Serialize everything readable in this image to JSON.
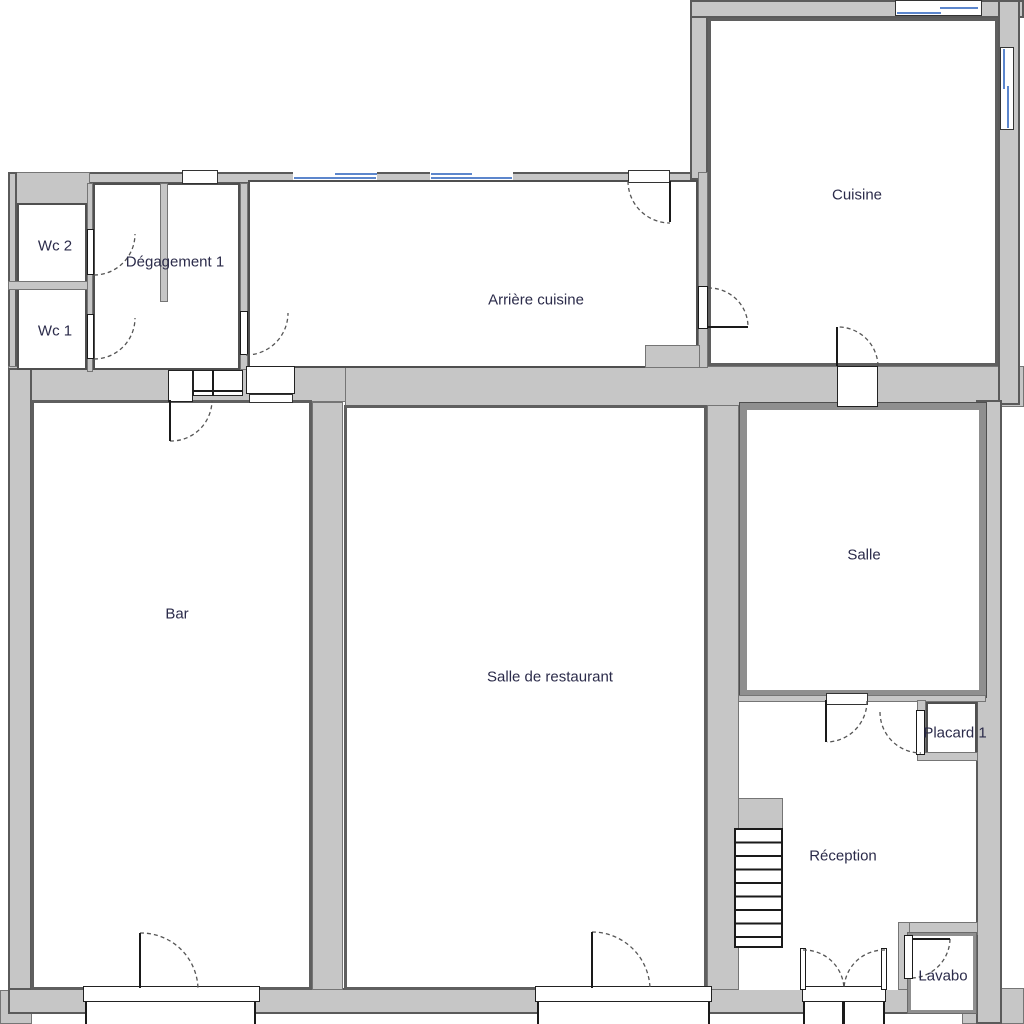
{
  "plan": {
    "type": "floor-plan",
    "rooms": [
      {
        "id": "wc2",
        "label": "Wc 2"
      },
      {
        "id": "wc1",
        "label": "Wc 1"
      },
      {
        "id": "degagement1",
        "label": "Dégagement 1"
      },
      {
        "id": "arriere_cuisine",
        "label": "Arrière cuisine"
      },
      {
        "id": "cuisine",
        "label": "Cuisine"
      },
      {
        "id": "bar",
        "label": "Bar"
      },
      {
        "id": "salle_de_restaurant",
        "label": "Salle de restaurant"
      },
      {
        "id": "salle",
        "label": "Salle"
      },
      {
        "id": "placard1",
        "label": "Placard 1"
      },
      {
        "id": "reception",
        "label": "Réception"
      },
      {
        "id": "lavabo",
        "label": "Lavabo"
      }
    ],
    "colors": {
      "wall_fill": "#c6c6c6",
      "wall_edge": "#757575",
      "room_border": "#4f4f4f",
      "door": "#1a1a1a",
      "window_blue": "#5c86cc",
      "text": "#2b2b4a",
      "floor": "#ffffff"
    }
  }
}
